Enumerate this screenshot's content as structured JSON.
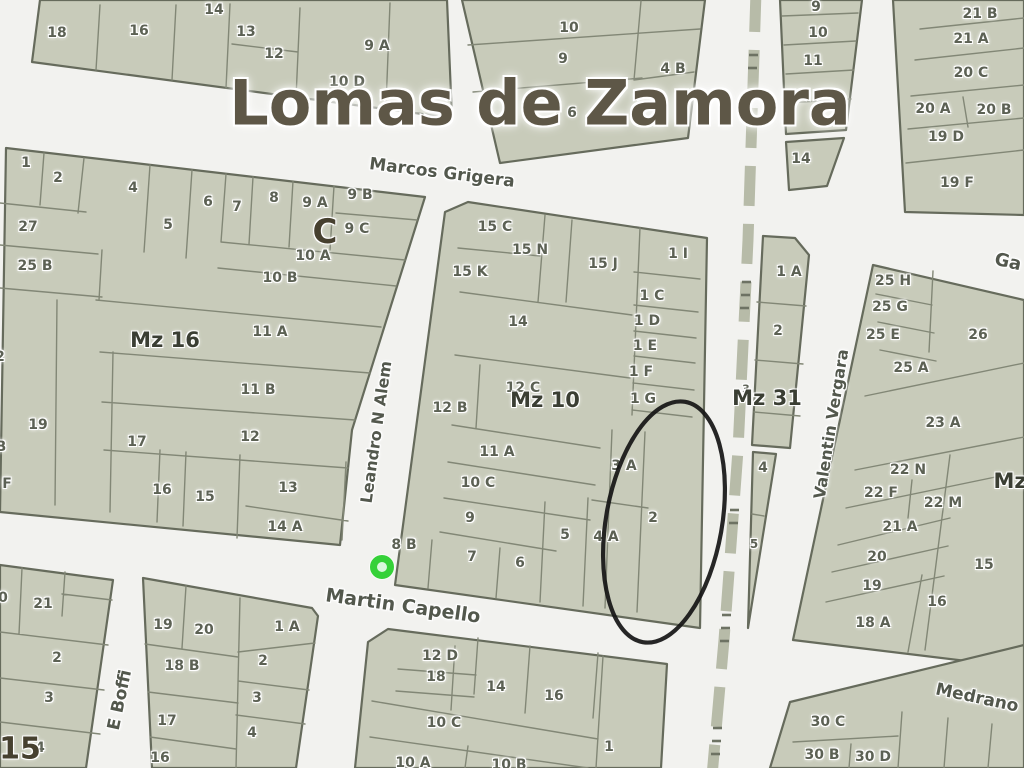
{
  "title": "Lomas de Zamora",
  "colors": {
    "street_background": "#f2f2ef",
    "parcel_fill": "#c8cbba",
    "block_border": "#666b5c",
    "title_text": "#5e5747",
    "parcel_text": "#5c6154",
    "block_label_text": "#3a3e33",
    "railway": "#b7bba8",
    "marker_green": "#35d138",
    "highlight_stroke": "#151515"
  },
  "streets": [
    {
      "name": "Marcos Grigera",
      "x": 442,
      "y": 173,
      "rot": 7,
      "size": 17
    },
    {
      "name": "Leandro N Alem",
      "x": 376,
      "y": 432,
      "rot": -82,
      "size": 16
    },
    {
      "name": "Martin Capello",
      "x": 403,
      "y": 606,
      "rot": 8,
      "size": 19
    },
    {
      "name": "Valentin Vergara",
      "x": 831,
      "y": 424,
      "rot": -81,
      "size": 16
    },
    {
      "name": "E Boffi",
      "x": 120,
      "y": 700,
      "rot": -78,
      "size": 17
    },
    {
      "name": "Medrano",
      "x": 977,
      "y": 698,
      "rot": 12,
      "size": 17
    },
    {
      "name": "Ga",
      "x": 1008,
      "y": 262,
      "rot": 13,
      "size": 18
    }
  ],
  "block_labels": [
    {
      "t": "Mz 16",
      "x": 165,
      "y": 340
    },
    {
      "t": "Mz 10",
      "x": 545,
      "y": 400
    },
    {
      "t": "Mz 31",
      "x": 767,
      "y": 398
    },
    {
      "t": "Mz",
      "x": 1010,
      "y": 481
    },
    {
      "t": "15",
      "x": 20,
      "y": 749,
      "cls": "big",
      "s": 30
    },
    {
      "t": "C",
      "x": 325,
      "y": 232,
      "cls": "big",
      "s": 34
    }
  ],
  "parcel_labels": [
    {
      "t": "18",
      "x": 57,
      "y": 33
    },
    {
      "t": "16",
      "x": 139,
      "y": 31
    },
    {
      "t": "14",
      "x": 214,
      "y": 10
    },
    {
      "t": "13",
      "x": 246,
      "y": 32
    },
    {
      "t": "12",
      "x": 274,
      "y": 54
    },
    {
      "t": "9 A",
      "x": 377,
      "y": 46
    },
    {
      "t": "10 D",
      "x": 347,
      "y": 82
    },
    {
      "t": "10",
      "x": 569,
      "y": 28
    },
    {
      "t": "9",
      "x": 563,
      "y": 59
    },
    {
      "t": "4 B",
      "x": 673,
      "y": 69
    },
    {
      "t": "6",
      "x": 572,
      "y": 113
    },
    {
      "t": "9",
      "x": 816,
      "y": 7
    },
    {
      "t": "10",
      "x": 818,
      "y": 33
    },
    {
      "t": "11",
      "x": 813,
      "y": 61
    },
    {
      "t": "14",
      "x": 801,
      "y": 159
    },
    {
      "t": "21 B",
      "x": 980,
      "y": 14
    },
    {
      "t": "21 A",
      "x": 971,
      "y": 39
    },
    {
      "t": "20 C",
      "x": 971,
      "y": 73
    },
    {
      "t": "20 A",
      "x": 933,
      "y": 109
    },
    {
      "t": "20 B",
      "x": 994,
      "y": 110
    },
    {
      "t": "19 D",
      "x": 946,
      "y": 137
    },
    {
      "t": "19 F",
      "x": 957,
      "y": 183
    },
    {
      "t": "1",
      "x": 26,
      "y": 163
    },
    {
      "t": "2",
      "x": 58,
      "y": 178
    },
    {
      "t": "4",
      "x": 133,
      "y": 188
    },
    {
      "t": "5",
      "x": 168,
      "y": 225
    },
    {
      "t": "6",
      "x": 208,
      "y": 202
    },
    {
      "t": "7",
      "x": 237,
      "y": 207
    },
    {
      "t": "8",
      "x": 274,
      "y": 198
    },
    {
      "t": "9 A",
      "x": 315,
      "y": 203
    },
    {
      "t": "9 B",
      "x": 360,
      "y": 195
    },
    {
      "t": "9 C",
      "x": 357,
      "y": 229
    },
    {
      "t": "27",
      "x": 28,
      "y": 227
    },
    {
      "t": "25 B",
      "x": 35,
      "y": 266
    },
    {
      "t": "10 A",
      "x": 313,
      "y": 256
    },
    {
      "t": "10 B",
      "x": 280,
      "y": 278
    },
    {
      "t": "11 A",
      "x": 270,
      "y": 332
    },
    {
      "t": "11 B",
      "x": 258,
      "y": 390
    },
    {
      "t": "12",
      "x": 250,
      "y": 437
    },
    {
      "t": "19",
      "x": 38,
      "y": 425
    },
    {
      "t": "17",
      "x": 137,
      "y": 442
    },
    {
      "t": "16",
      "x": 162,
      "y": 490
    },
    {
      "t": "15",
      "x": 205,
      "y": 497
    },
    {
      "t": "13",
      "x": 288,
      "y": 488
    },
    {
      "t": "14 A",
      "x": 285,
      "y": 527
    },
    {
      "t": "2",
      "x": 0,
      "y": 357
    },
    {
      "t": "B",
      "x": 1,
      "y": 447
    },
    {
      "t": "F",
      "x": 7,
      "y": 484
    },
    {
      "t": "15 C",
      "x": 495,
      "y": 227
    },
    {
      "t": "15 N",
      "x": 530,
      "y": 250
    },
    {
      "t": "15 K",
      "x": 470,
      "y": 272
    },
    {
      "t": "15 J",
      "x": 603,
      "y": 264
    },
    {
      "t": "1 I",
      "x": 678,
      "y": 254
    },
    {
      "t": "1 C",
      "x": 652,
      "y": 296
    },
    {
      "t": "1 D",
      "x": 647,
      "y": 321
    },
    {
      "t": "1 E",
      "x": 645,
      "y": 346
    },
    {
      "t": "1 F",
      "x": 641,
      "y": 372
    },
    {
      "t": "1 G",
      "x": 643,
      "y": 399
    },
    {
      "t": "14",
      "x": 518,
      "y": 322
    },
    {
      "t": "12 C",
      "x": 523,
      "y": 388
    },
    {
      "t": "12 B",
      "x": 450,
      "y": 408
    },
    {
      "t": "11 A",
      "x": 497,
      "y": 452
    },
    {
      "t": "10 C",
      "x": 478,
      "y": 483
    },
    {
      "t": "9",
      "x": 470,
      "y": 518
    },
    {
      "t": "8 B",
      "x": 404,
      "y": 545
    },
    {
      "t": "7",
      "x": 472,
      "y": 557
    },
    {
      "t": "6",
      "x": 520,
      "y": 563
    },
    {
      "t": "5",
      "x": 565,
      "y": 535
    },
    {
      "t": "4 A",
      "x": 606,
      "y": 537
    },
    {
      "t": "3 A",
      "x": 624,
      "y": 466
    },
    {
      "t": "2",
      "x": 653,
      "y": 518
    },
    {
      "t": "1 A",
      "x": 789,
      "y": 272
    },
    {
      "t": "2",
      "x": 778,
      "y": 331
    },
    {
      "t": "3",
      "x": 746,
      "y": 389,
      "s": 11
    },
    {
      "t": "4",
      "x": 763,
      "y": 468
    },
    {
      "t": "5",
      "x": 754,
      "y": 544,
      "s": 12
    },
    {
      "t": "25 H",
      "x": 893,
      "y": 281
    },
    {
      "t": "25 G",
      "x": 890,
      "y": 307
    },
    {
      "t": "25 E",
      "x": 883,
      "y": 335
    },
    {
      "t": "26",
      "x": 978,
      "y": 335
    },
    {
      "t": "25 A",
      "x": 911,
      "y": 368
    },
    {
      "t": "23 A",
      "x": 943,
      "y": 423
    },
    {
      "t": "22 N",
      "x": 908,
      "y": 470
    },
    {
      "t": "22 F",
      "x": 881,
      "y": 493
    },
    {
      "t": "22 M",
      "x": 943,
      "y": 503
    },
    {
      "t": "21 A",
      "x": 900,
      "y": 527
    },
    {
      "t": "20",
      "x": 877,
      "y": 557
    },
    {
      "t": "19",
      "x": 872,
      "y": 586
    },
    {
      "t": "18 A",
      "x": 873,
      "y": 623
    },
    {
      "t": "16",
      "x": 937,
      "y": 602
    },
    {
      "t": "15",
      "x": 984,
      "y": 565
    },
    {
      "t": "0",
      "x": 3,
      "y": 598
    },
    {
      "t": "21",
      "x": 43,
      "y": 604
    },
    {
      "t": "2",
      "x": 57,
      "y": 658
    },
    {
      "t": "3",
      "x": 49,
      "y": 698
    },
    {
      "t": "4",
      "x": 40,
      "y": 748
    },
    {
      "t": "19",
      "x": 163,
      "y": 625
    },
    {
      "t": "20",
      "x": 204,
      "y": 630
    },
    {
      "t": "1 A",
      "x": 287,
      "y": 627
    },
    {
      "t": "18 B",
      "x": 182,
      "y": 666
    },
    {
      "t": "2",
      "x": 263,
      "y": 661
    },
    {
      "t": "3",
      "x": 257,
      "y": 698
    },
    {
      "t": "17",
      "x": 167,
      "y": 721
    },
    {
      "t": "4",
      "x": 252,
      "y": 733
    },
    {
      "t": "16",
      "x": 160,
      "y": 758
    },
    {
      "t": "12 D",
      "x": 440,
      "y": 656
    },
    {
      "t": "18",
      "x": 436,
      "y": 677
    },
    {
      "t": "14",
      "x": 496,
      "y": 687
    },
    {
      "t": "16",
      "x": 554,
      "y": 696
    },
    {
      "t": "10 C",
      "x": 444,
      "y": 723
    },
    {
      "t": "10 A",
      "x": 413,
      "y": 763
    },
    {
      "t": "10 B",
      "x": 509,
      "y": 765
    },
    {
      "t": "1",
      "x": 609,
      "y": 747
    },
    {
      "t": "30 C",
      "x": 828,
      "y": 722
    },
    {
      "t": "30 B",
      "x": 822,
      "y": 755
    },
    {
      "t": "30 D",
      "x": 873,
      "y": 757
    }
  ],
  "markers": {
    "green_dot": {
      "x": 382,
      "y": 567
    },
    "highlight_ellipse": {
      "cx": 664,
      "cy": 522,
      "rx": 58,
      "ry": 122,
      "rot": 10
    }
  }
}
